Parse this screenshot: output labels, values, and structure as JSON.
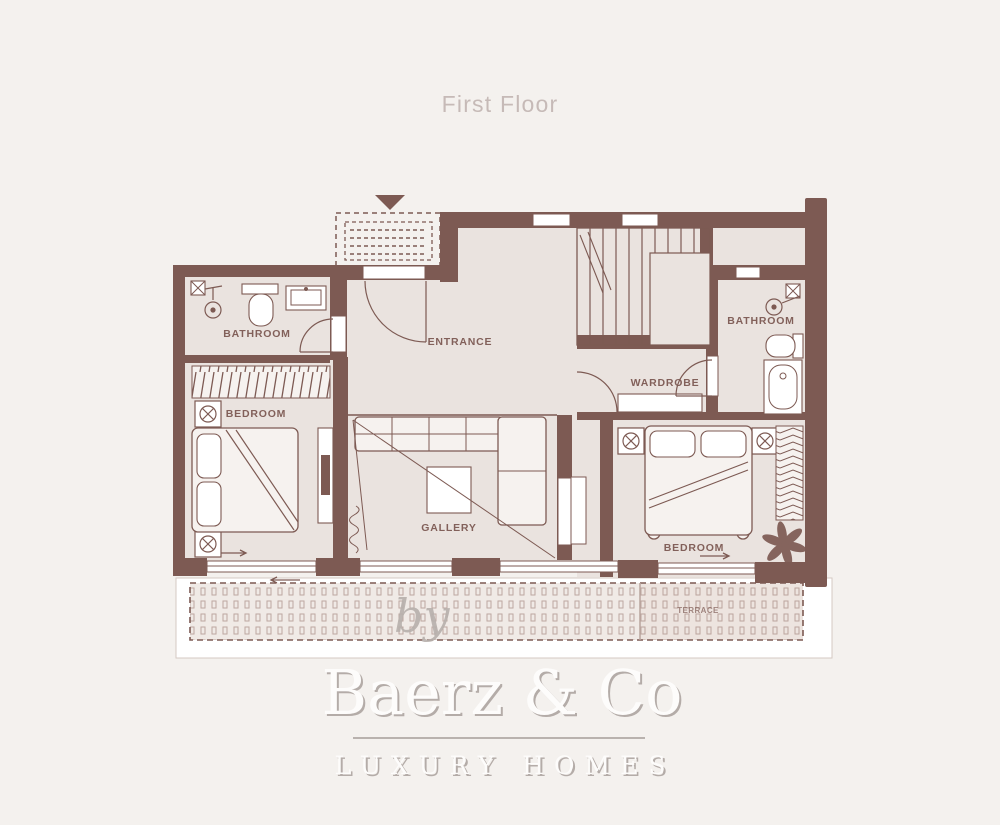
{
  "title": "First Floor",
  "plan": {
    "rooms": [
      {
        "id": "entrance",
        "label": "ENTRANCE"
      },
      {
        "id": "bathroom_left",
        "label": "BATHROOM"
      },
      {
        "id": "bedroom_left",
        "label": "BEDROOM"
      },
      {
        "id": "gallery",
        "label": "GALLERY"
      },
      {
        "id": "wardrobe",
        "label": "WARDROBE"
      },
      {
        "id": "bathroom_right",
        "label": "BATHROOM"
      },
      {
        "id": "bedroom_right",
        "label": "BEDROOM"
      },
      {
        "id": "terrace",
        "label": "TERRACE"
      }
    ]
  },
  "watermark": {
    "prefix": "by",
    "brand": "Baerz & Co",
    "tagline": "LUXURY HOMES"
  },
  "colors": {
    "background": "#f4f1ee",
    "wall": "#7d5a53",
    "floor": "#eae3df",
    "terrace": "#f0eae6",
    "title": "#c6bab7",
    "watermark": "#fdfcfb",
    "watermark_shadow": "#b4aca8",
    "divider": "#a59d99",
    "by": "#b7b0ac"
  }
}
